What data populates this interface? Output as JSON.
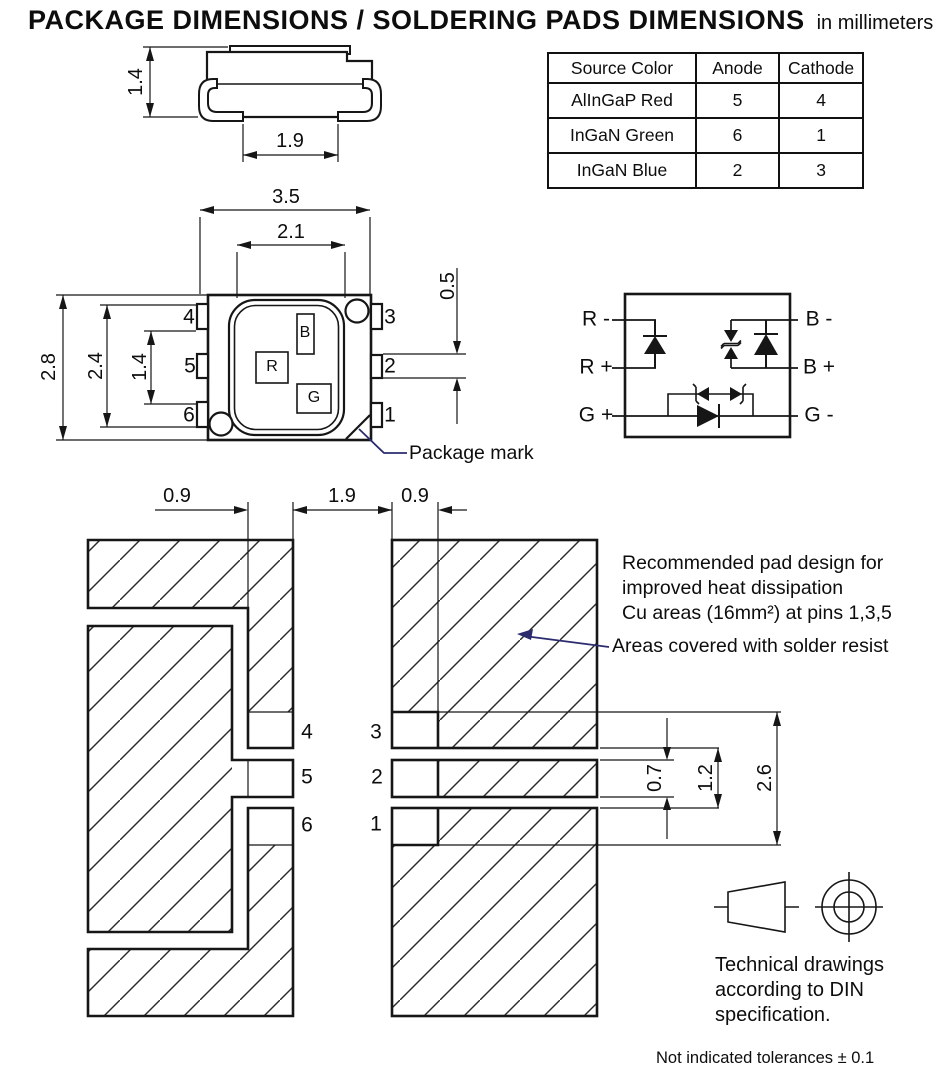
{
  "title": {
    "main": "PACKAGE DIMENSIONS / SOLDERING PADS DIMENSIONS",
    "units": "in millimeters"
  },
  "pinout_table": {
    "headers": {
      "source": "Source Color",
      "anode": "Anode",
      "cathode": "Cathode"
    },
    "rows": [
      {
        "source": "AlInGaP Red",
        "anode": "5",
        "cathode": "4"
      },
      {
        "source": "InGaN Green",
        "anode": "6",
        "cathode": "1"
      },
      {
        "source": "InGaN Blue",
        "anode": "2",
        "cathode": "3"
      }
    ]
  },
  "side_view": {
    "dim_height": "1.4",
    "dim_lead_span": "1.9"
  },
  "top_view": {
    "dim_width": "3.5",
    "dim_window": "2.1",
    "dim_pin_height": "0.5",
    "dim_height": "2.8",
    "dim_pin_span": "2.4",
    "dim_pin_pitch": "1.4",
    "left_pins": [
      "4",
      "5",
      "6"
    ],
    "right_pins": [
      "3",
      "2",
      "1"
    ],
    "chip_blue": "B",
    "chip_red": "R",
    "chip_green": "G",
    "package_mark_label": "Package mark"
  },
  "circuit": {
    "r_minus": "R -",
    "r_plus": "R +",
    "g_plus": "G +",
    "b_minus": "B -",
    "b_plus": "B +",
    "g_minus": "G -"
  },
  "pad_layout": {
    "dim_pad_left": "0.9",
    "dim_gap": "1.9",
    "dim_pad_right": "0.9",
    "dim_pad2_height": "0.7",
    "dim_gap_vert": "1.2",
    "dim_span_vert": "2.6",
    "left_pins": [
      "4",
      "5",
      "6"
    ],
    "right_pins": [
      "3",
      "2",
      "1"
    ],
    "note_line1": "Recommended pad design for",
    "note_line2": "improved heat dissipation",
    "note_line3": "Cu areas (16mm²) at pins 1,3,5",
    "solder_resist_label": "Areas covered with solder resist"
  },
  "footer": {
    "din_line1": "Technical drawings",
    "din_line2": "according to DIN",
    "din_line3": "specification.",
    "tolerance_note": "Not indicated tolerances ± 0.1"
  },
  "colors": {
    "line": "#161616",
    "leader": "#2b2b6e"
  }
}
